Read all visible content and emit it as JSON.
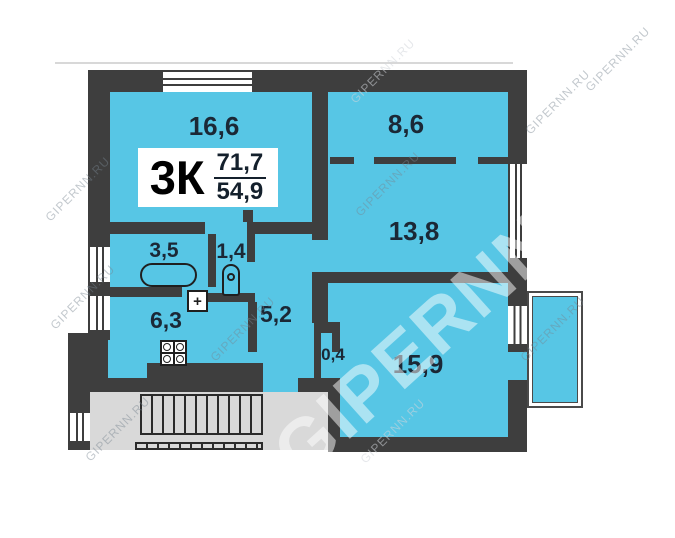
{
  "plan": {
    "info": {
      "type": "3К",
      "total_area": "71,7",
      "living_area": "54,9"
    },
    "rooms": [
      {
        "name": "living-room",
        "area": "16,6"
      },
      {
        "name": "bedroom-top-right",
        "area": "8,6"
      },
      {
        "name": "bedroom-middle-right",
        "area": "13,8"
      },
      {
        "name": "bathroom",
        "area": "3,5"
      },
      {
        "name": "toilet",
        "area": "1,4"
      },
      {
        "name": "hallway",
        "area": "5,2"
      },
      {
        "name": "kitchen",
        "area": "6,3"
      },
      {
        "name": "closet",
        "area": "0,4"
      },
      {
        "name": "bedroom-bottom-right",
        "area": "15,9"
      }
    ],
    "symbols": {
      "heater": "+"
    },
    "watermark": {
      "small": "GIPERNN.RU",
      "big": "GIPERNN"
    },
    "colors": {
      "wall": "#3E3E3E",
      "room_fill": "#57C6E5",
      "stairwell": "#D9D9D9",
      "label": "#1B2836"
    }
  }
}
